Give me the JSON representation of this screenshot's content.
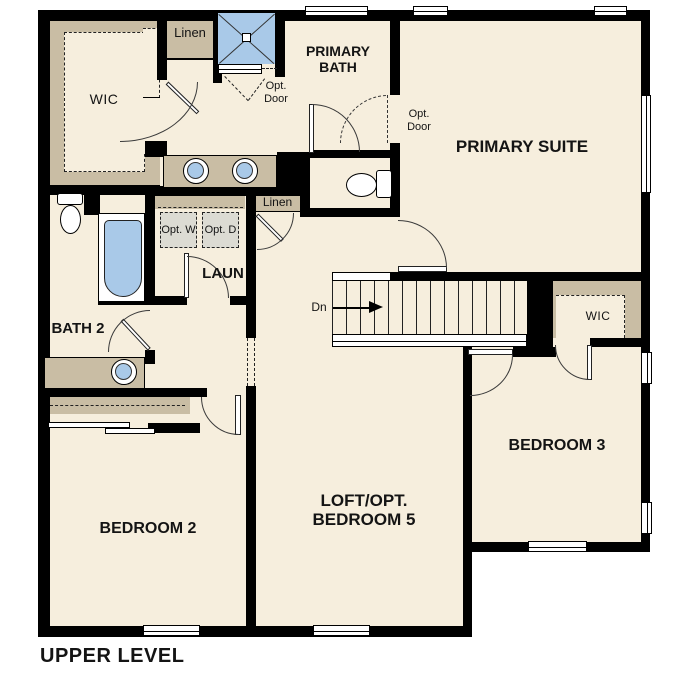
{
  "title": "UPPER LEVEL",
  "rooms": {
    "wic_primary": "WIC",
    "linen_top": "Linen",
    "primary_bath": "PRIMARY BATH",
    "primary_suite": "PRIMARY SUITE",
    "linen_hall": "Linen",
    "laundry": "LAUN",
    "bath2": "BATH 2",
    "wic_bedroom3": "WIC",
    "bedroom3": "BEDROOM 3",
    "bedroom2": "BEDROOM 2",
    "loft": "LOFT/OPT. BEDROOM 5"
  },
  "annotations": {
    "opt_door": "Opt. Door",
    "opt_washer": "Opt. W",
    "opt_dryer": "Opt. D",
    "stairs_down": "Dn"
  },
  "fixtures": [
    "shower-icon",
    "sink-icon",
    "toilet-icon",
    "bathtub-icon",
    "washer-icon",
    "dryer-icon",
    "stairs-down-arrow-icon",
    "window-icon",
    "door-swing-icon"
  ],
  "colors": {
    "floor": "#f6eedd",
    "wall": "#000000",
    "casework": "#c9bda4",
    "fixture": "#a9c9e8",
    "appliance": "#dcdbd3",
    "text": "#141414"
  }
}
